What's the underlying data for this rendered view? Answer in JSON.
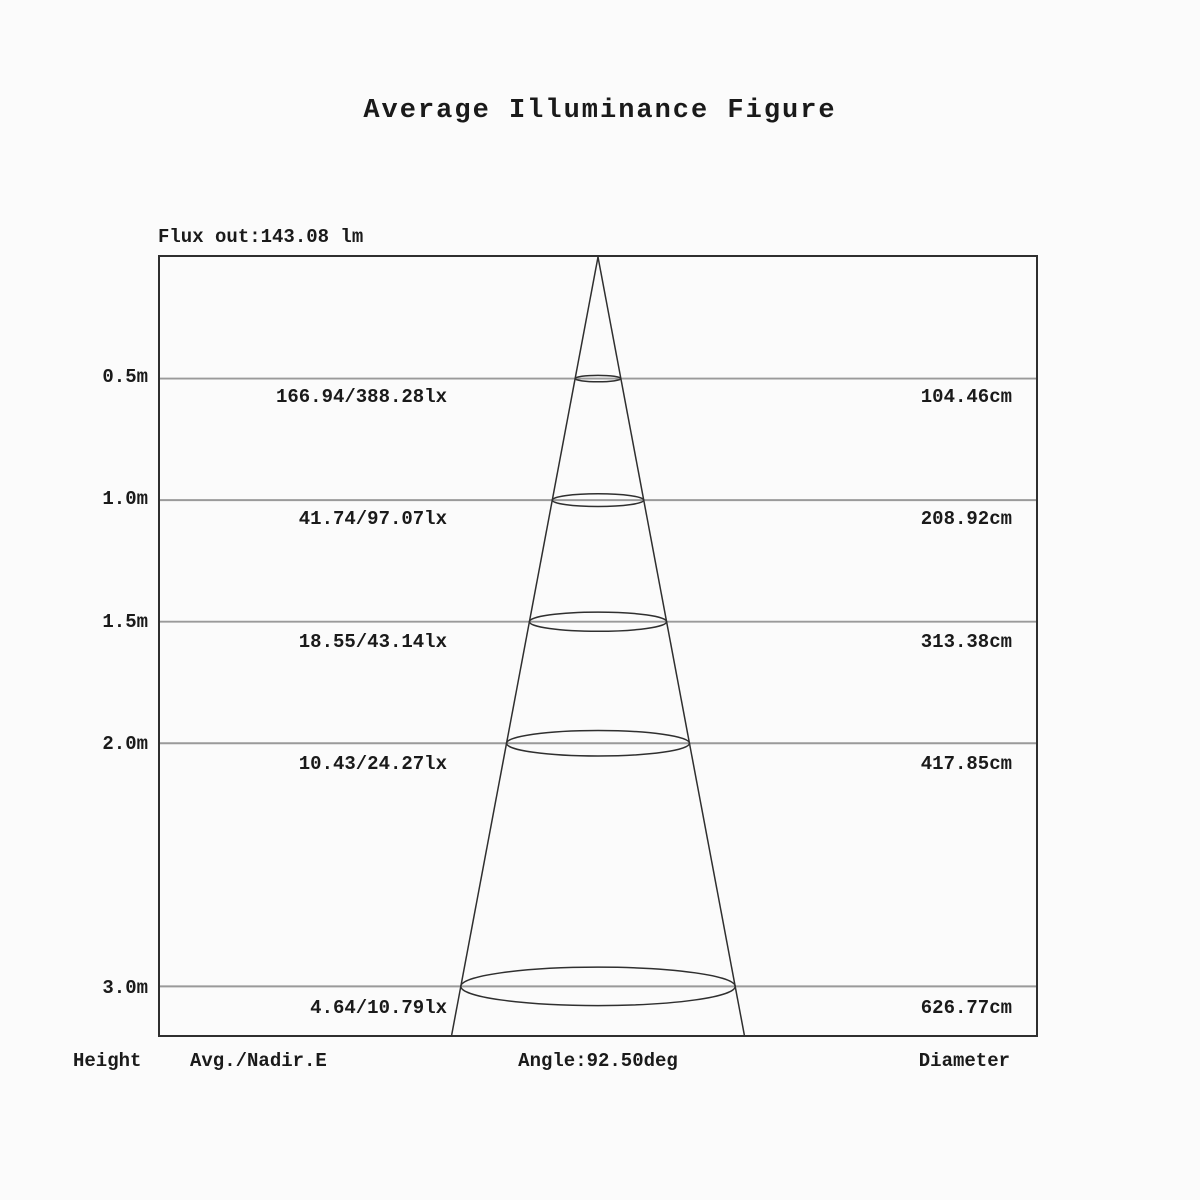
{
  "title": "Average Illuminance Figure",
  "flux_label": "Flux out:143.08 lm",
  "footer": {
    "height": "Height",
    "avg_nadir": "Avg./Nadir.E",
    "angle": "Angle:92.50deg",
    "diameter": "Diameter"
  },
  "chart_data": {
    "type": "table",
    "description": "Photometric cone diagram showing average/nadir illuminance and beam diameter at increasing distances from the light source",
    "title": "Average Illuminance Figure",
    "flux_out_lm": 143.08,
    "flux_out_label": "Flux out:143.08 lm",
    "beam_angle_deg": 92.5,
    "beam_angle_label": "Angle:92.50deg",
    "columns": [
      "Height",
      "Avg./Nadir.E",
      "Diameter"
    ],
    "ylim": [
      0,
      3.2
    ],
    "grid": true,
    "rows": [
      {
        "height": "0.5m",
        "height_m": 0.5,
        "avg_nadir_lx": "166.94/388.28lx",
        "avg_lx": 166.94,
        "nadir_lx": 388.28,
        "diameter": "104.46cm",
        "diameter_cm": 104.46
      },
      {
        "height": "1.0m",
        "height_m": 1.0,
        "avg_nadir_lx": "41.74/97.07lx",
        "avg_lx": 41.74,
        "nadir_lx": 97.07,
        "diameter": "208.92cm",
        "diameter_cm": 208.92
      },
      {
        "height": "1.5m",
        "height_m": 1.5,
        "avg_nadir_lx": "18.55/43.14lx",
        "avg_lx": 18.55,
        "nadir_lx": 43.14,
        "diameter": "313.38cm",
        "diameter_cm": 313.38
      },
      {
        "height": "2.0m",
        "height_m": 2.0,
        "avg_nadir_lx": "10.43/24.27lx",
        "avg_lx": 10.43,
        "nadir_lx": 24.27,
        "diameter": "417.85cm",
        "diameter_cm": 417.85
      },
      {
        "height": "3.0m",
        "height_m": 3.0,
        "avg_nadir_lx": "4.64/10.79lx",
        "avg_lx": 4.64,
        "nadir_lx": 10.79,
        "diameter": "626.77cm",
        "diameter_cm": 626.77
      }
    ],
    "colors": {
      "text": "#1a1a1a",
      "grid_line": "#9a9a9a",
      "box_border": "#2f2f2f",
      "cone_line": "#2f2f2f",
      "background": "#fbfbfb"
    }
  }
}
